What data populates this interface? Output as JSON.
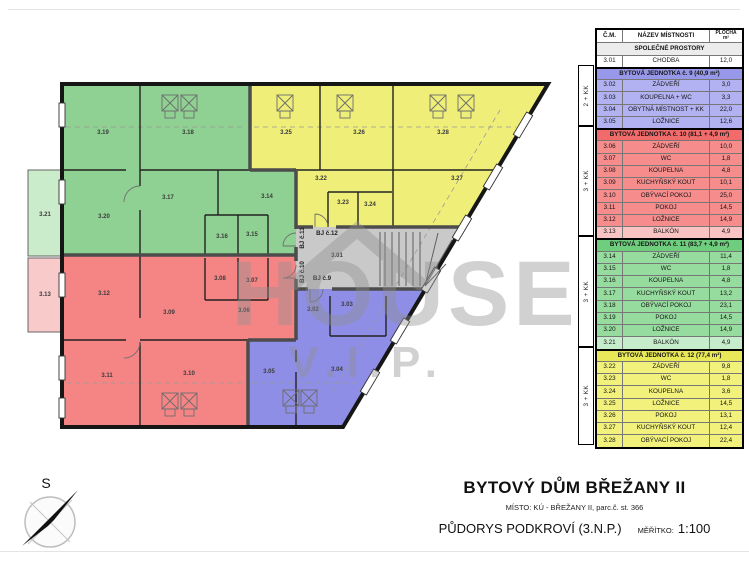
{
  "colors": {
    "green": "#8fd192",
    "green_light": "#cbeccb",
    "yellow": "#eeee78",
    "red": "#f58585",
    "red_light": "#f9caca",
    "blue": "#8e8ee6",
    "gray": "#c9c9c9",
    "tbl_blue_hdr": "#9898ea",
    "tbl_blue": "#b2b2f2",
    "tbl_red_hdr": "#f26b6b",
    "tbl_red": "#f68c8c",
    "tbl_red_light": "#f9c3c3",
    "tbl_green_hdr": "#6fce7e",
    "tbl_green": "#97dc9f",
    "tbl_green_light": "#c6edcb",
    "tbl_yellow_hdr": "#e8e858",
    "tbl_yellow": "#f1f17c"
  },
  "plan": {
    "watermark_line1": "HOUSE",
    "watermark_line2": "V.I.P.",
    "compass_label": "S",
    "room_labels": [
      {
        "id": "3.01",
        "x": 337,
        "y": 257
      },
      {
        "id": "3.02",
        "x": 313,
        "y": 311
      },
      {
        "id": "3.03",
        "x": 347,
        "y": 306
      },
      {
        "id": "3.04",
        "x": 337,
        "y": 371
      },
      {
        "id": "3.05",
        "x": 269,
        "y": 373
      },
      {
        "id": "3.06",
        "x": 244,
        "y": 312
      },
      {
        "id": "3.07",
        "x": 252,
        "y": 282
      },
      {
        "id": "3.08",
        "x": 220,
        "y": 280
      },
      {
        "id": "3.09",
        "x": 169,
        "y": 314
      },
      {
        "id": "3.10",
        "x": 189,
        "y": 375
      },
      {
        "id": "3.11",
        "x": 107,
        "y": 377
      },
      {
        "id": "3.12",
        "x": 104,
        "y": 295
      },
      {
        "id": "3.13",
        "x": 45,
        "y": 296
      },
      {
        "id": "3.14",
        "x": 267,
        "y": 198
      },
      {
        "id": "3.15",
        "x": 252,
        "y": 236
      },
      {
        "id": "3.16",
        "x": 222,
        "y": 238
      },
      {
        "id": "3.17",
        "x": 168,
        "y": 199
      },
      {
        "id": "3.18",
        "x": 188,
        "y": 134
      },
      {
        "id": "3.19",
        "x": 103,
        "y": 134
      },
      {
        "id": "3.20",
        "x": 104,
        "y": 218
      },
      {
        "id": "3.21",
        "x": 45,
        "y": 216
      },
      {
        "id": "3.22",
        "x": 321,
        "y": 180
      },
      {
        "id": "3.23",
        "x": 343,
        "y": 204
      },
      {
        "id": "3.24",
        "x": 370,
        "y": 206
      },
      {
        "id": "3.25",
        "x": 286,
        "y": 134
      },
      {
        "id": "3.26",
        "x": 359,
        "y": 134
      },
      {
        "id": "3.27",
        "x": 457,
        "y": 180
      },
      {
        "id": "3.28",
        "x": 443,
        "y": 134
      }
    ],
    "door_labels": [
      {
        "text": "BJ č.12",
        "x": 327,
        "y": 235,
        "vertical": false
      },
      {
        "text": "BJ č.11",
        "x": 304,
        "y": 238,
        "vertical": true
      },
      {
        "text": "BJ č.10",
        "x": 304,
        "y": 272,
        "vertical": true
      },
      {
        "text": "BJ č.9",
        "x": 322,
        "y": 280,
        "vertical": false
      }
    ]
  },
  "legend": {
    "header": {
      "col_id": "Č.M.",
      "col_name": "NÁZEV MÍSTNOSTI",
      "col_area": "PLOCHA",
      "col_area_unit": "m²"
    },
    "sections": [
      {
        "kind": "common",
        "title": "SPOLEČNÉ PROSTORY",
        "rows": [
          {
            "id": "3.01",
            "name": "CHODBA",
            "area": "12,0"
          }
        ]
      },
      {
        "kind": "apt",
        "key": "blue",
        "unit": "2 + KK",
        "title": "BYTOVÁ JEDNOTKA č. 9 (40,9 m²)",
        "rows": [
          {
            "id": "3.02",
            "name": "ZÁDVEŘÍ",
            "area": "3,0"
          },
          {
            "id": "3.03",
            "name": "KOUPELNA + WC",
            "area": "3,3"
          },
          {
            "id": "3.04",
            "name": "OBYTNÁ MÍSTNOST + KK",
            "area": "22,0"
          },
          {
            "id": "3.05",
            "name": "LOŽNICE",
            "area": "12,6"
          }
        ]
      },
      {
        "kind": "apt",
        "key": "red",
        "unit": "3 + KK",
        "title": "BYTOVÁ JEDNOTKA č. 10 (81,1 + 4,9 m²)",
        "rows": [
          {
            "id": "3.06",
            "name": "ZÁDVEŘÍ",
            "area": "10,0"
          },
          {
            "id": "3.07",
            "name": "WC",
            "area": "1,8"
          },
          {
            "id": "3.08",
            "name": "KOUPELNA",
            "area": "4,8"
          },
          {
            "id": "3.09",
            "name": "KUCHYŇSKÝ KOUT",
            "area": "10,1"
          },
          {
            "id": "3.10",
            "name": "OBÝVACÍ POKOJ",
            "area": "25,0"
          },
          {
            "id": "3.11",
            "name": "POKOJ",
            "area": "14,5"
          },
          {
            "id": "3.12",
            "name": "LOŽNICE",
            "area": "14,9"
          },
          {
            "id": "3.13",
            "name": "BALKÓN",
            "area": "4,9",
            "light": true
          }
        ]
      },
      {
        "kind": "apt",
        "key": "green",
        "unit": "3 + KK",
        "title": "BYTOVÁ JEDNOTKA č. 11 (83,7 + 4,9 m²)",
        "rows": [
          {
            "id": "3.14",
            "name": "ZÁDVEŘÍ",
            "area": "11,4"
          },
          {
            "id": "3.15",
            "name": "WC",
            "area": "1,8"
          },
          {
            "id": "3.16",
            "name": "KOUPELNA",
            "area": "4,8"
          },
          {
            "id": "3.17",
            "name": "KUCHYŇSKÝ KOUT",
            "area": "13,2"
          },
          {
            "id": "3.18",
            "name": "OBÝVACÍ POKOJ",
            "area": "23,1"
          },
          {
            "id": "3.19",
            "name": "POKOJ",
            "area": "14,5"
          },
          {
            "id": "3.20",
            "name": "LOŽNICE",
            "area": "14,9"
          },
          {
            "id": "3.21",
            "name": "BALKÓN",
            "area": "4,9",
            "light": true
          }
        ]
      },
      {
        "kind": "apt",
        "key": "yellow",
        "unit": "3 + KK",
        "title": "BYTOVÁ JEDNOTKA č. 12 (77,4 m²)",
        "rows": [
          {
            "id": "3.22",
            "name": "ZÁDVEŘÍ",
            "area": "9,8"
          },
          {
            "id": "3.23",
            "name": "WC",
            "area": "1,8"
          },
          {
            "id": "3.24",
            "name": "KOUPELNA",
            "area": "3,6"
          },
          {
            "id": "3.25",
            "name": "LOŽNICE",
            "area": "14,5"
          },
          {
            "id": "3.26",
            "name": "POKOJ",
            "area": "13,1"
          },
          {
            "id": "3.27",
            "name": "KUCHYŇSKÝ KOUT",
            "area": "12,4"
          },
          {
            "id": "3.28",
            "name": "OBÝVACÍ POKOJ",
            "area": "22,4"
          }
        ]
      }
    ]
  },
  "title_block": {
    "title": "BYTOVÝ DŮM BŘEŽANY II",
    "subtitle": "MÍSTO: KÚ - BŘEŽANY II, parc.č. st. 366",
    "drawing": "PŮDORYS PODKROVÍ (3.N.P.)",
    "scale_label": "MĚŘÍTKO:",
    "scale_value": "1:100"
  }
}
